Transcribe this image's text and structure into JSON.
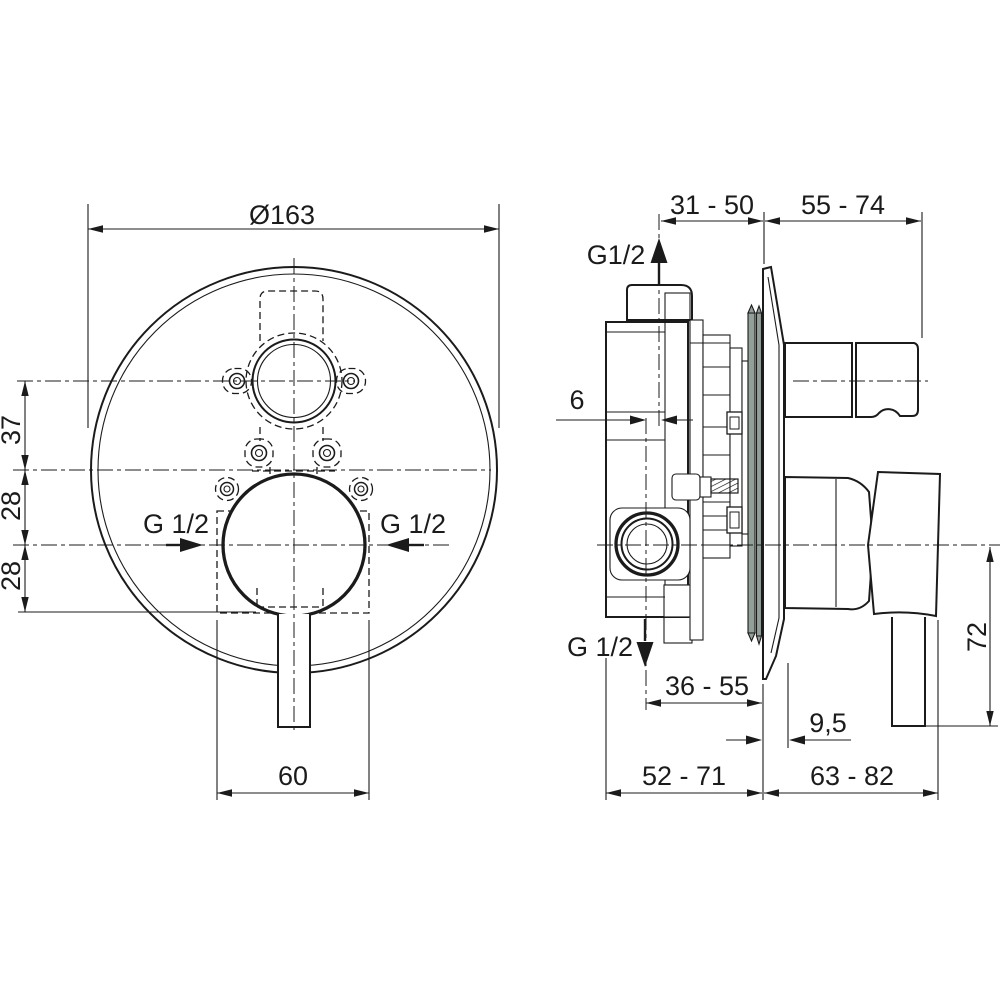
{
  "front_view": {
    "plate_diameter": "Ø163",
    "dim_diverter_offset": "37",
    "dim_center_upper": "28",
    "dim_center_lower": "28",
    "inlet_label_left": "G 1/2",
    "inlet_label_right": "G 1/2",
    "dim_box_width": "60"
  },
  "side_view": {
    "dim_recess": "31 - 50",
    "dim_projection": "55 - 74",
    "outlet_label_top": "G1/2",
    "dim_adjust": "6",
    "outlet_label_bottom": "G 1/2",
    "dim_outlet_depth": "36 - 55",
    "dim_plate_offset": "9,5",
    "dim_body_depth": "52 - 71",
    "dim_handle_projection": "63 - 82",
    "dim_lever_length": "72"
  },
  "colors": {
    "line": "#1b1b1b",
    "body_fill": "#dce8e2",
    "seal_fill": "#93a09a",
    "background": "#ffffff"
  }
}
